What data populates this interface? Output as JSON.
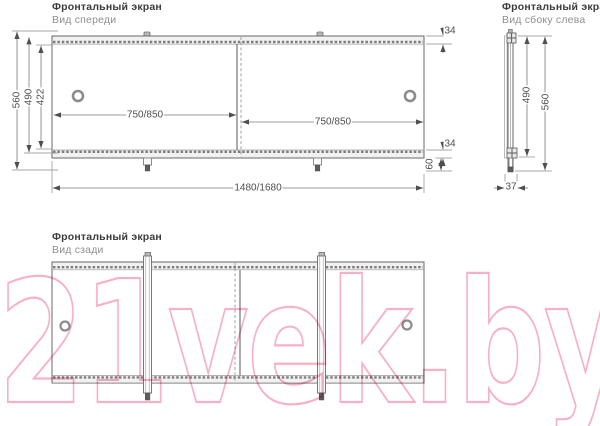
{
  "watermark": {
    "text": "21vek.by",
    "color": "#f6a7be"
  },
  "views": {
    "front": {
      "title": "Фронтальный экран",
      "subtitle": "Вид спереди",
      "dims": {
        "height_total": "560",
        "height_body": "490",
        "height_inner": "422",
        "rail_top": "34",
        "rail_bottom": "34",
        "foot": "60",
        "panel_left": "750/850",
        "panel_right": "750/850",
        "width_total": "1480/1680"
      }
    },
    "side": {
      "title": "Фронтальный экран",
      "subtitle": "Вид сбоку слева",
      "dims": {
        "height_body": "490",
        "height_total": "560",
        "depth": "37"
      }
    },
    "rear": {
      "title": "Фронтальный экран",
      "subtitle": "Вид сзади"
    }
  }
}
